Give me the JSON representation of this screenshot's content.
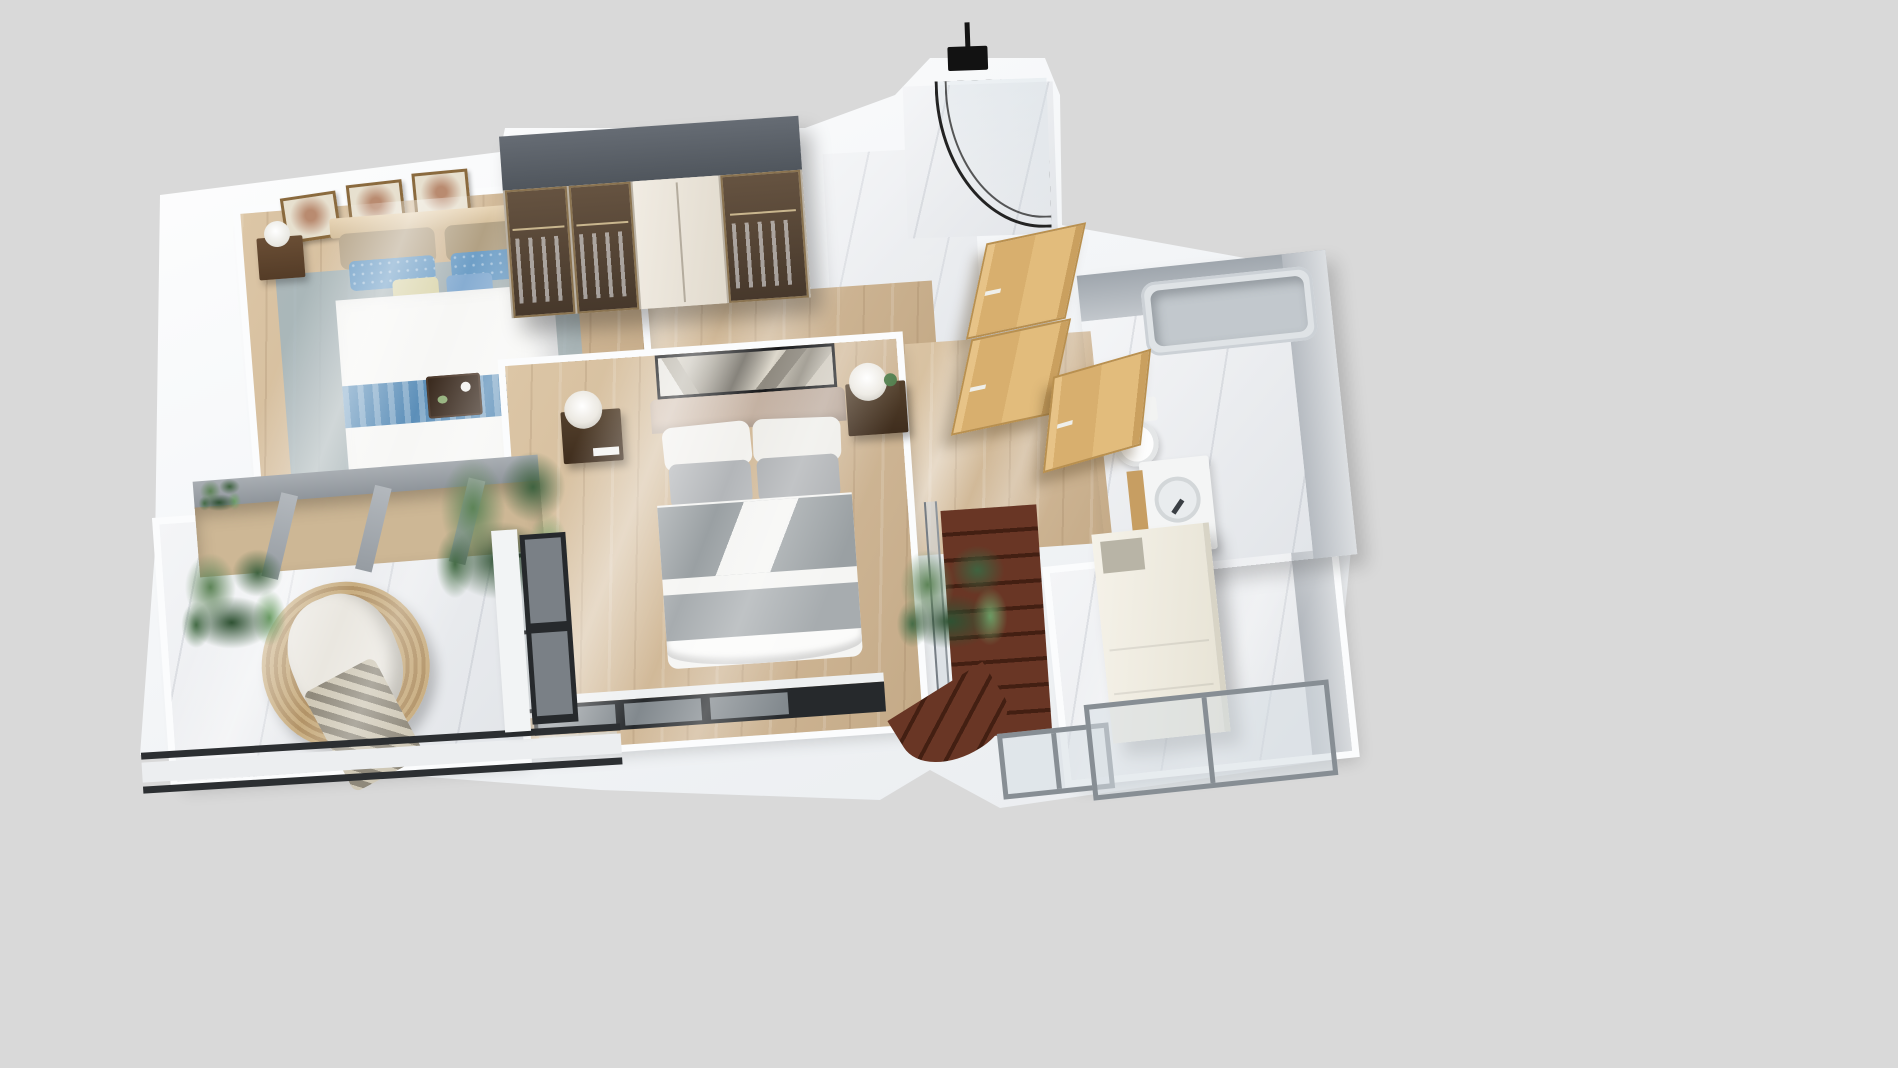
{
  "scene": {
    "description": "Photoreal 3D dollhouse-style floor plan render of an apartment upper floor seen from above at an angle, on a plain grey studio backdrop. No text, labels or UI controls are rendered.",
    "view": "top-down isometric cutaway",
    "background_color": "#d9d9d9",
    "palette": {
      "wall_white": "#f7f8fa",
      "wood_floor": "#d3bd9d",
      "marble_floor": "#eff0f2",
      "wardrobe_top_grey": "#5b6169",
      "door_oak": "#ddb87c",
      "stair_walnut": "#5d2e1f",
      "textile_blue": "#5d90ba",
      "textile_grey": "#9aa0a3",
      "plant_green": "#3f6340",
      "rattan_tan": "#c0a57a",
      "frame_black": "#232323",
      "railing_grey": "#9aa1a8",
      "bench_cream": "#e8decb"
    }
  },
  "rooms": {
    "secondary_bedroom": {
      "floor": "light oak planks with blue-grey area rug",
      "items": [
        "double bed with white duvet, tan and blue patterned pillows, blue runner",
        "dark wood breakfast tray on bed",
        "two dark-wood nightstands with white table lamps",
        "cream storage bench at bed foot",
        "three gold-framed botanical prints along headboard wall"
      ]
    },
    "wardrobe_wall": {
      "items": [
        "long wardrobe with dark grey top, bronze-glass doors showing hung clothes, white double doors at center"
      ]
    },
    "master_bedroom": {
      "floor": "light oak planks",
      "items": [
        "king bed with champagne upholstered headboard, white and grey pillows, grey blanket and white sheet",
        "black geometric art panel behind headboard",
        "two dark-wood bedside tables with white sphere lamps, books and small plant",
        "black-framed corner window",
        "black-framed window wall at bottom"
      ]
    },
    "shower_room": {
      "floor": "white marble",
      "items": [
        "curved black-framed glass shower enclosure",
        "ceiling-mounted black rain shower head"
      ]
    },
    "bathroom": {
      "floor": "white marble with grey stone walls",
      "items": [
        "built-in grey bathtub",
        "white toilet",
        "vanity with round white basin, black faucet and oak cabinet"
      ]
    },
    "hallway": {
      "floor": "light oak planks and marble landing",
      "items": [
        "three light-oak doors standing open",
        "potted plant beside stairwell"
      ]
    },
    "staircase": {
      "items": [
        "dark walnut winder staircase descending",
        "frosted glass railing with grey posts"
      ]
    },
    "balcony": {
      "floor": "white marble tile",
      "items": [
        "round rattan lounge chair with white cushion and houndstooth throw",
        "potted plants",
        "grey beam railing over the void",
        "black window rails along outer edge"
      ]
    },
    "terrace_hall": {
      "floor": "white marble tile",
      "items": [
        "tall cream storage cabinet",
        "grey-framed sliding glass windows"
      ]
    }
  },
  "labels": {
    "plan": "upper-floor 3D plan",
    "bedroom2": "secondary bedroom",
    "rug": "blue-grey area rug",
    "bed2": "double bed with blue bedding",
    "runner": "patterned blue bed runner",
    "tray": "dark wood breakfast tray",
    "bench": "cream bedroom bench",
    "nightstand": "dark wood nightstand with lamp",
    "frame": "gold-framed botanical print",
    "wardrobe": "glass-front wardrobe",
    "master": "master bedroom",
    "art": "black geometric art panel",
    "bedM": "king bed with grey bedding",
    "winbay": "black-framed corner window",
    "winwall": "black-framed window wall",
    "shower": "shower room",
    "showerhead": "rain shower head",
    "showerglass": "curved shower glass",
    "landing": "marble landing",
    "door": "light oak door",
    "bathroom": "bathroom",
    "bathtub": "built-in bathtub",
    "toilet": "toilet",
    "vanity": "vanity sink with oak cabinet",
    "stairs": "dark walnut staircase",
    "railing": "glass stair railing",
    "plant": "potted plant",
    "balcony": "balcony terrace",
    "chair": "round rattan lounge chair",
    "throw": "houndstooth throw blanket",
    "pergola": "grey beam railing over void",
    "cabinet": "cream storage cabinet",
    "terrace": "marble terrace hall",
    "window": "grey-framed sliding window",
    "rail": "black balcony window rail"
  }
}
